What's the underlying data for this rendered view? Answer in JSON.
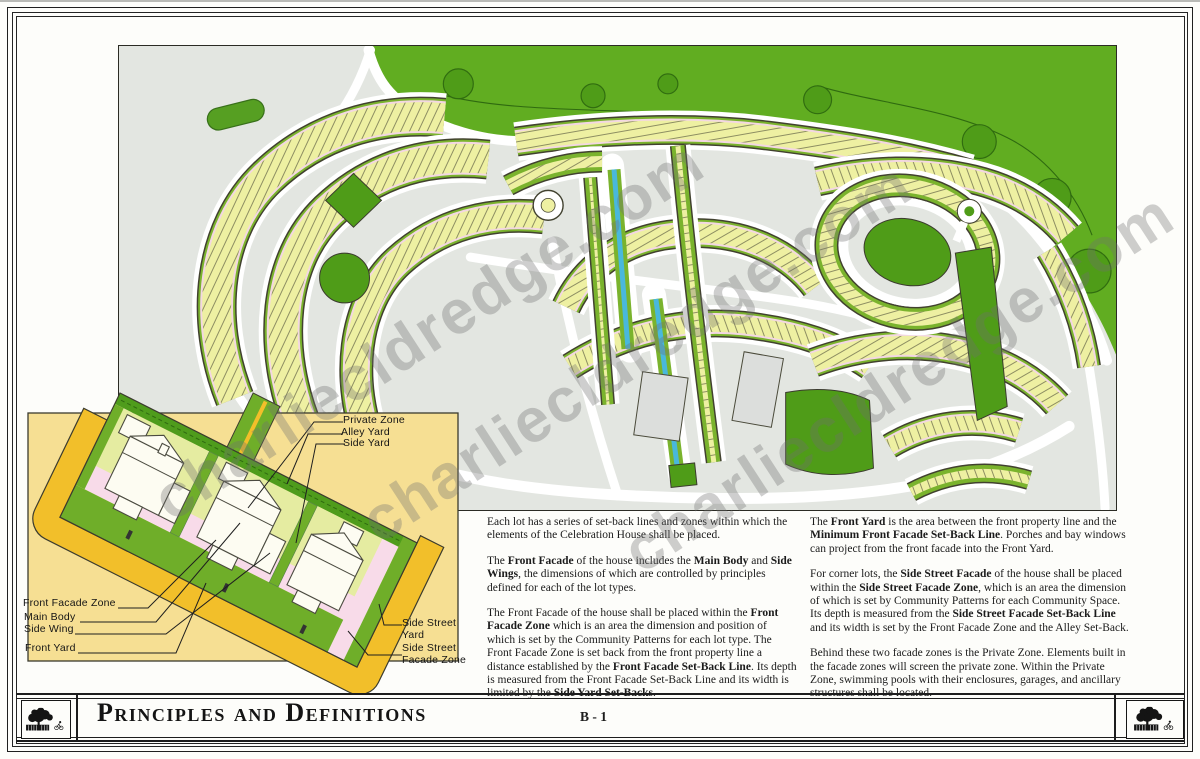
{
  "watermark": {
    "text": "charliecldredge.com",
    "color": "#707070"
  },
  "colors": {
    "lot_yellow": "#eef0a2",
    "street_green": "#7ab32d",
    "forest": "#61ad21",
    "forest_dark": "#4f9c18",
    "park": "#4f9c18",
    "canal": "#49b8dc",
    "facade_pink": "#f3d7e2",
    "panel_yellow": "#f6df93",
    "road_yellow": "#f2bf2a",
    "map_bg": "#e3e6e1",
    "alley_green": "#4f9c1c",
    "private_green": "#e5eca1",
    "lawn_green": "#6fae29",
    "ink": "#1c1c1c",
    "band_outline": "#41412f"
  },
  "inset": {
    "labels": {
      "private_zone": "Private Zone",
      "alley_yard": "Alley Yard",
      "side_yard": "Side Yard",
      "front_facade_zone": "Front Facade Zone",
      "main_body": "Main Body",
      "side_wing": "Side Wing",
      "front_yard": "Front Yard",
      "side_street_yard": "Side Street\nYard",
      "side_street_facade_zone": "Side Street\nFacade Zone"
    }
  },
  "columns": {
    "left": [
      [
        {
          "t": "Each lot has a series of set-back lines and zones within which the elements of the Celebration House shall be placed.",
          "b": false
        }
      ],
      [
        {
          "t": "The ",
          "b": false
        },
        {
          "t": "Front Facade",
          "b": true
        },
        {
          "t": " of the house includes the ",
          "b": false
        },
        {
          "t": "Main Body",
          "b": true
        },
        {
          "t": " and ",
          "b": false
        },
        {
          "t": "Side Wings",
          "b": true
        },
        {
          "t": ", the dimensions of which are controlled by principles defined for each of the lot types.",
          "b": false
        }
      ],
      [
        {
          "t": "The Front Facade of the house shall be placed within the ",
          "b": false
        },
        {
          "t": "Front Facade Zone",
          "b": true
        },
        {
          "t": " which is an area the dimension and position of which is set by the Community Patterns for each lot type. The Front Facade Zone is set back from the front property line a distance established by the ",
          "b": false
        },
        {
          "t": "Front Facade Set-Back Line",
          "b": true
        },
        {
          "t": ". Its depth is measured from the Front Facade Set-Back Line and its width is limited by the ",
          "b": false
        },
        {
          "t": "Side Yard Set-Backs",
          "b": true
        },
        {
          "t": ".",
          "b": false
        }
      ]
    ],
    "right": [
      [
        {
          "t": "The ",
          "b": false
        },
        {
          "t": "Front Yard",
          "b": true
        },
        {
          "t": " is the area between the front property line and the ",
          "b": false
        },
        {
          "t": "Minimum Front Facade Set-Back Line",
          "b": true
        },
        {
          "t": ". Porches and bay windows can project from the front facade into the Front Yard.",
          "b": false
        }
      ],
      [
        {
          "t": "For corner lots, the ",
          "b": false
        },
        {
          "t": "Side Street Facade",
          "b": true
        },
        {
          "t": " of the house shall be placed within the ",
          "b": false
        },
        {
          "t": "Side Street Facade Zone",
          "b": true
        },
        {
          "t": ", which is an area the dimension of which is set by Community Patterns for each Community Space. Its depth is measured from the ",
          "b": false
        },
        {
          "t": "Side Street Facade Set-Back Line",
          "b": true
        },
        {
          "t": " and its width is set by the Front Facade Zone and the Alley Set-Back.",
          "b": false
        }
      ],
      [
        {
          "t": "Behind these two facade zones is the Private Zone. Elements built in the facade zones will screen the private zone. Within the Private Zone, swimming pools with their enclosures, garages, and ancillary structures shall be located.",
          "b": false
        }
      ]
    ]
  },
  "footer": {
    "title": "Principles and Definitions",
    "page_number": "B - 1",
    "left_logo_icon": "celebration-tree-logo",
    "right_logo_icon": "celebration-tree-logo"
  }
}
